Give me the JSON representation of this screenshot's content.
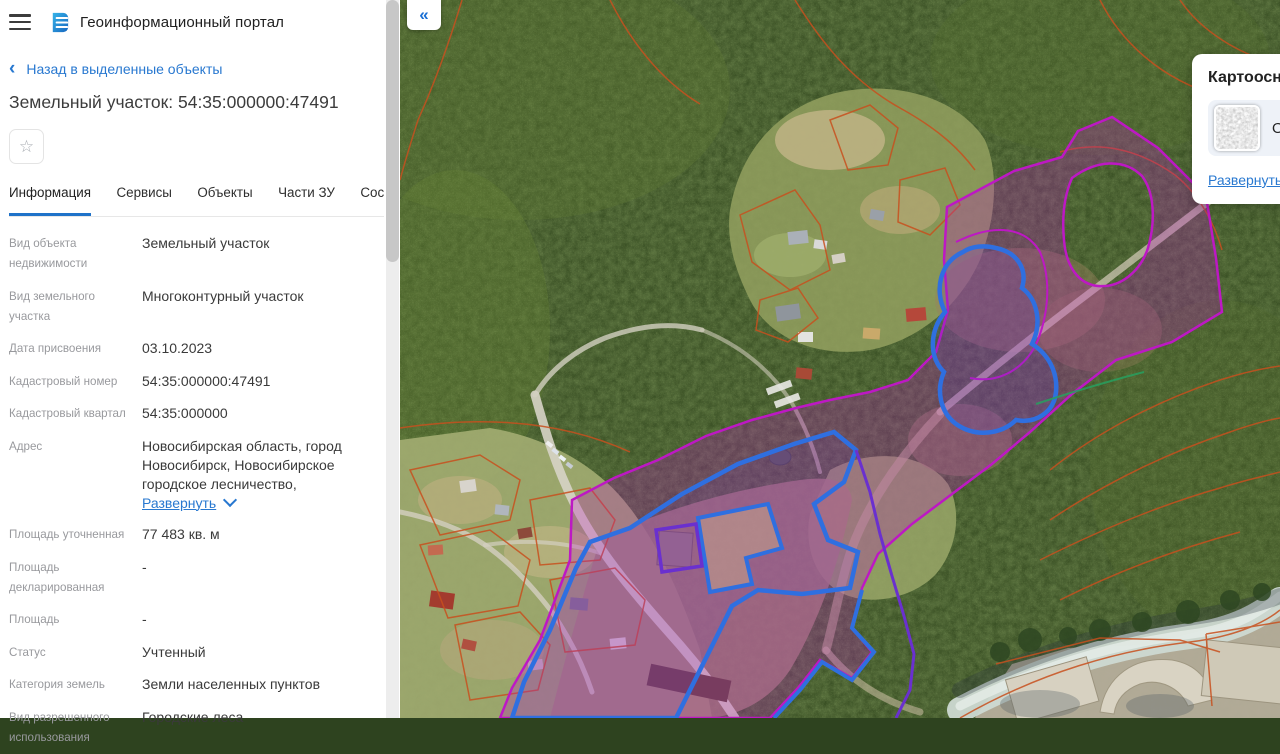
{
  "app": {
    "title": "Геоинформационный портал"
  },
  "colors": {
    "accent": "#1f72c9",
    "link": "#2878d0",
    "magenta": "#bd18c4",
    "blue": "#2f6fe0",
    "violet": "#6a30cf",
    "orange": "#c8501e",
    "teal": "#27a05f"
  },
  "icons": {
    "menu": "hamburger-bars",
    "back": "‹",
    "favorite": "☆",
    "tabs_more": "▶",
    "collapse": "«",
    "address_expand": "chevron-down",
    "card_expand": "chevron-down"
  },
  "panel": {
    "back_label": "Назад в выделенные объекты",
    "title": "Земельный участок: 54:35:000000:47491",
    "tabs": [
      {
        "label": "Информация",
        "active": true
      },
      {
        "label": "Сервисы",
        "active": false
      },
      {
        "label": "Объекты",
        "active": false
      },
      {
        "label": "Части ЗУ",
        "active": false
      },
      {
        "label": "Состав ЕЗ",
        "active": false
      }
    ],
    "fields": [
      {
        "label": "Вид объекта недвижимости",
        "value": "Земельный участок"
      },
      {
        "label": "Вид земельного участка",
        "value": "Многоконтурный участок"
      },
      {
        "label": "Дата присвоения",
        "value": "03.10.2023"
      },
      {
        "label": "Кадастровый номер",
        "value": "54:35:000000:47491"
      },
      {
        "label": "Кадастровый квартал",
        "value": "54:35:000000"
      },
      {
        "label": "Адрес",
        "value": "Новосибирская область, город Новосибирск, Новосибирское городское лесничество,",
        "link_label": "Развернуть"
      },
      {
        "label": "Площадь уточненная",
        "value": "77 483 кв. м"
      },
      {
        "label": "Площадь декларированная",
        "value": "-"
      },
      {
        "label": "Площадь",
        "value": "-"
      },
      {
        "label": "Статус",
        "value": "Учтенный"
      },
      {
        "label": "Категория земель",
        "value": "Земли населенных пунктов"
      },
      {
        "label": "Вид разрешенного использования",
        "value": "Городские леса"
      }
    ]
  },
  "map": {
    "card": {
      "title": "Картооснова",
      "option_label": "Ортофотоплан",
      "expand_label": "Развернуть"
    }
  }
}
